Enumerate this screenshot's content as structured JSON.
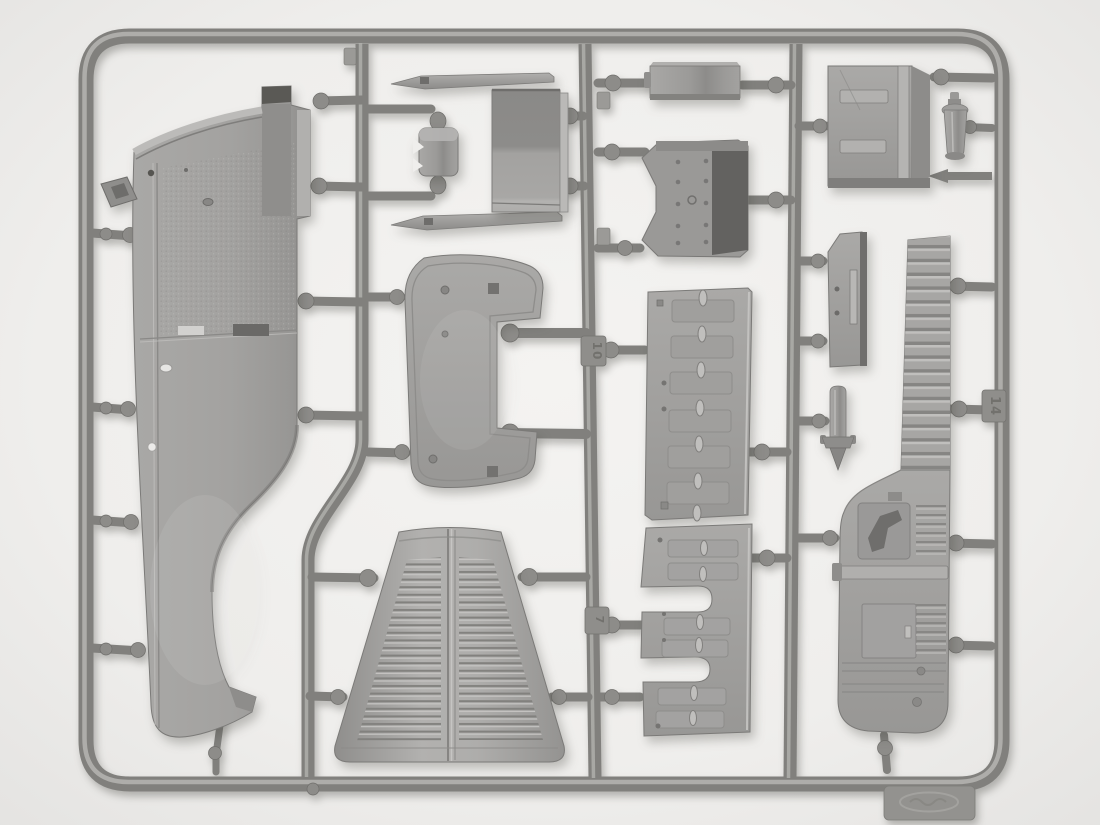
{
  "scene": {
    "title": "Plastic model kit sprue",
    "description": "Top-down photograph of a grey injection-moulded sprue (parts frame) from a scale truck model kit on a white background. The frame holds a cab side panel, louvered engine hood, roof panel, seat, firewall, hinged hood side panels, a running-board panel and small detail parts."
  },
  "palette": {
    "background": "#f0efed",
    "frame_tube": "#81807d",
    "frame_highlight": "#b6b5b2",
    "plastic_mid": "#a3a2a0",
    "plastic_light": "#c2c1bf",
    "plastic_dark": "#6f6e6c",
    "accent_dark": "#5a5955",
    "shadow": "rgba(70,68,62,0.3)"
  },
  "sprue": {
    "mold_numbers": [
      {
        "label": "10"
      },
      {
        "label": "7"
      },
      {
        "label": "14"
      }
    ],
    "brand_tab": {
      "note": "embossed manufacturer logo tab (illegible)"
    },
    "parts": [
      {
        "id": "cab-side-panel",
        "label": "Cab side panel with wheel arch"
      },
      {
        "id": "windshield-trim-upper",
        "label": "Thin trim strip"
      },
      {
        "id": "windshield-trim-lower",
        "label": "Thin trim strip"
      },
      {
        "id": "bracket-box",
        "label": "Small mounting box"
      },
      {
        "id": "seat-cushion",
        "label": "Seat cushion block"
      },
      {
        "id": "stowage-box",
        "label": "Stowage box"
      },
      {
        "id": "firewall-panel",
        "label": "Riveted firewall panel"
      },
      {
        "id": "cab-rear-panel",
        "label": "Cab rear panel with brackets"
      },
      {
        "id": "pump-bottle",
        "label": "Small pump bottle"
      },
      {
        "id": "cab-roof-panel",
        "label": "Cab roof panel with cutout"
      },
      {
        "id": "hinged-side-panel",
        "label": "Hood side panel with hinge knobs"
      },
      {
        "id": "notched-side-panel",
        "label": "Hood side panel with U cutouts"
      },
      {
        "id": "louvered-hood",
        "label": "Louvered engine hood"
      },
      {
        "id": "mounting-plate",
        "label": "Mounting plate with slot"
      },
      {
        "id": "ground-spike",
        "label": "Ground spike plug"
      },
      {
        "id": "running-board",
        "label": "Running board / fender panel"
      }
    ]
  }
}
